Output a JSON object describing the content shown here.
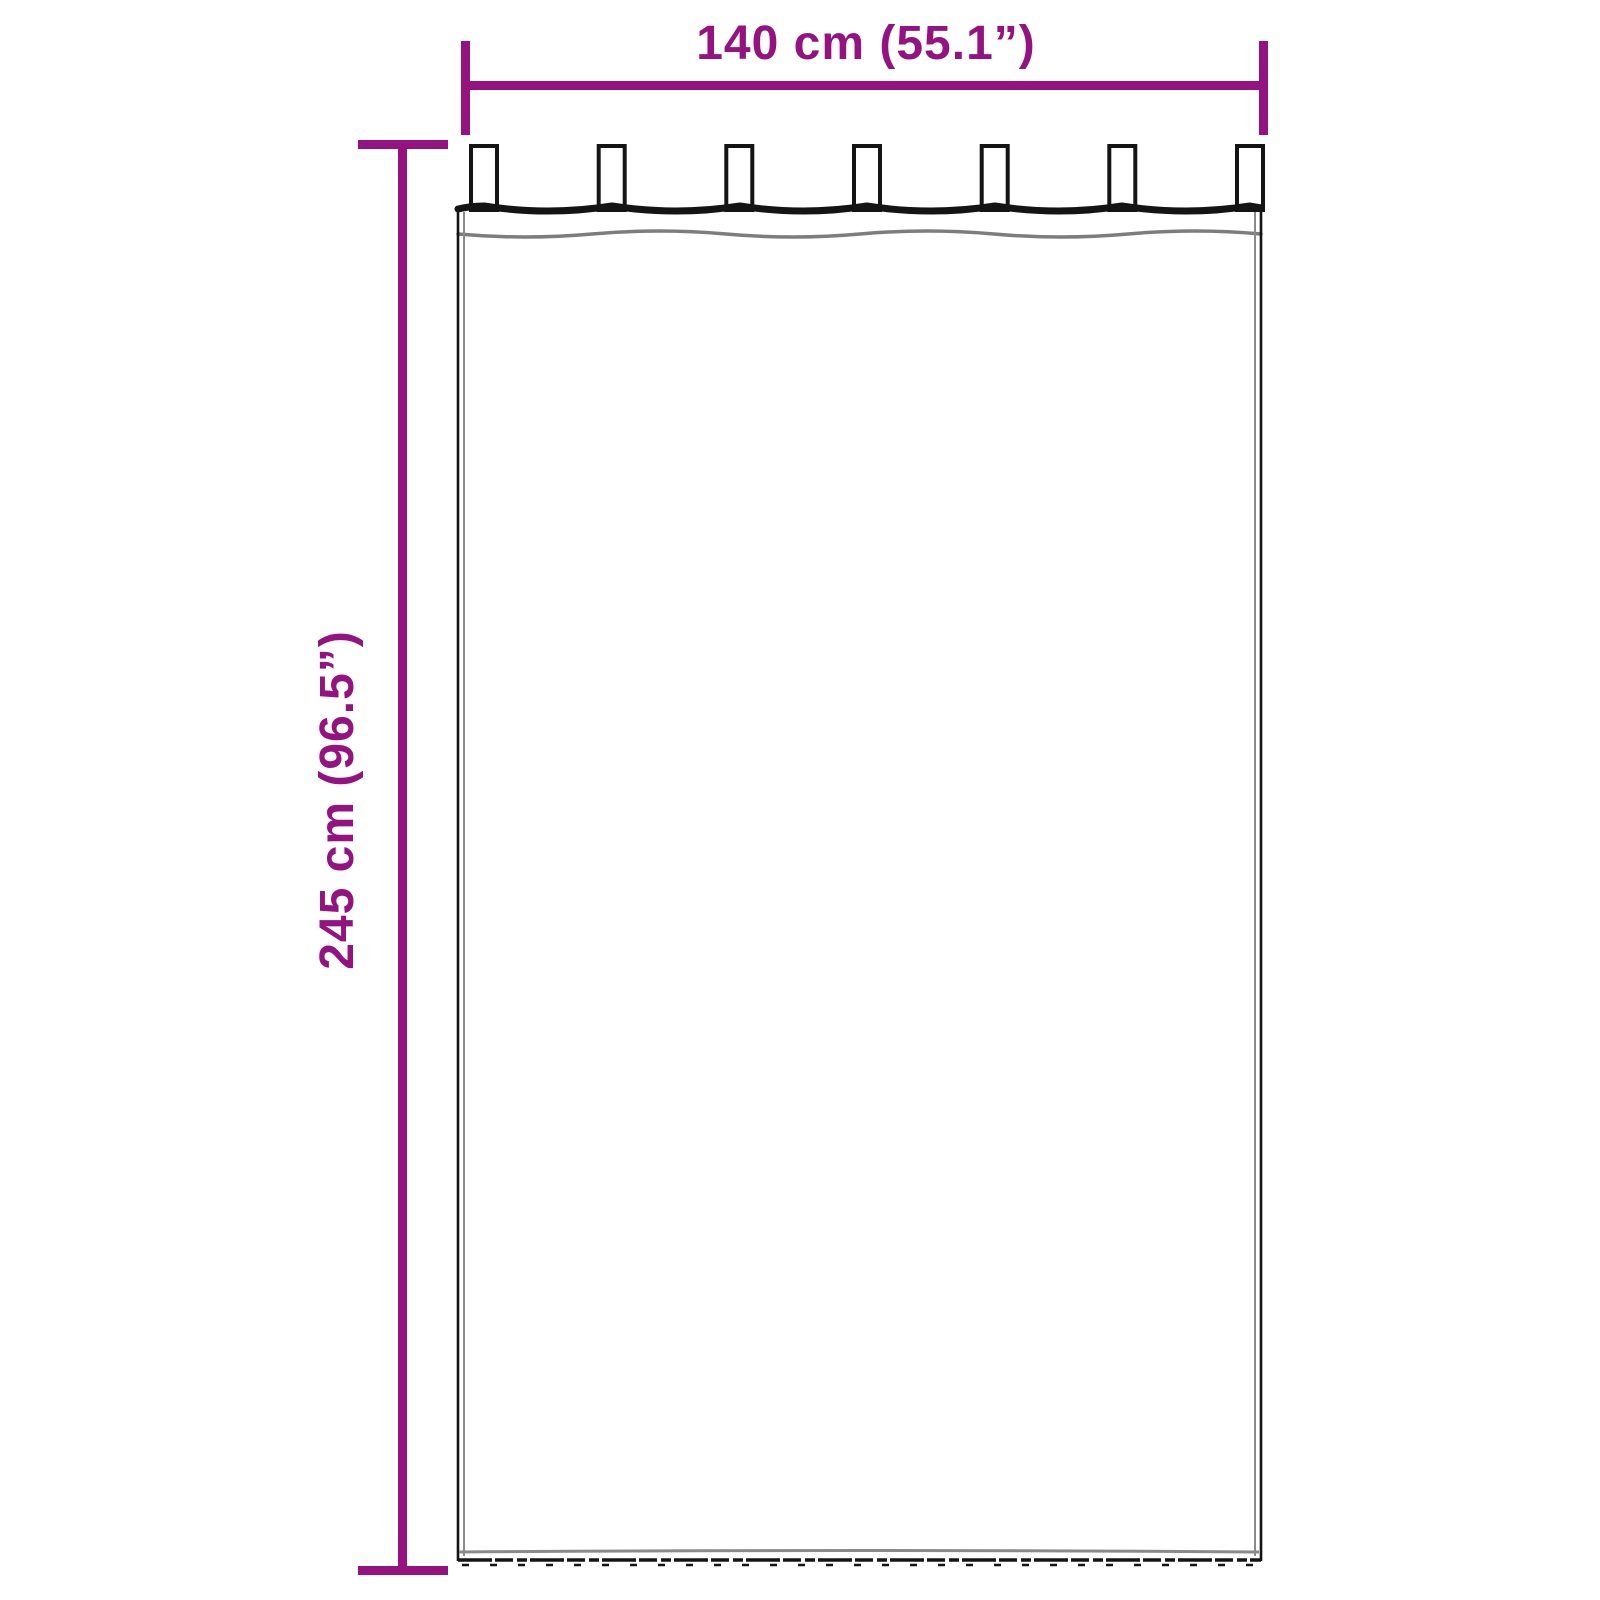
{
  "diagram": {
    "illustration_name": "tab-top-curtain-front-view",
    "width_label": "140 cm (55.1”)",
    "height_label": "245 cm (96.5”)",
    "tabs_count": 7,
    "colors": {
      "dimension": "#951380",
      "outline": "#141414",
      "soft_line": "#8a8a8a",
      "background": "#ffffff",
      "curtain_fill": "#ffffff"
    }
  }
}
